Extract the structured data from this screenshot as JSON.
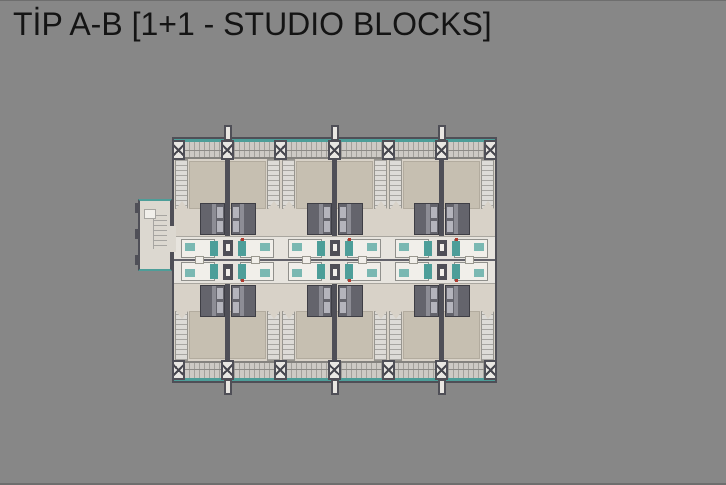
{
  "title": "TİP A-B [1+1 - STUDIO BLOCKS]",
  "plan": {
    "kind": "architectural floor plan",
    "unit_rows": 2,
    "unit_pairs_per_row": 3
  },
  "colors": {
    "background": "#878787",
    "title_text": "#141414",
    "wall": "#4f4f57",
    "floor": "#d8d2c8",
    "carpet": "#c6bfb1",
    "balcony": "#cdcac5",
    "hatch": "#a3a19c",
    "teal": "#4d9e99",
    "stair": "#dddbd7",
    "tread": "#a7a5a1",
    "bed": "#64646c",
    "pillow": "#b4b4bc",
    "bath": "#e7e4de",
    "room": "#f1efea",
    "column": "#e9e7e3",
    "marker_red": "#b03a2e",
    "annex_floor": "#dcd8d0"
  }
}
